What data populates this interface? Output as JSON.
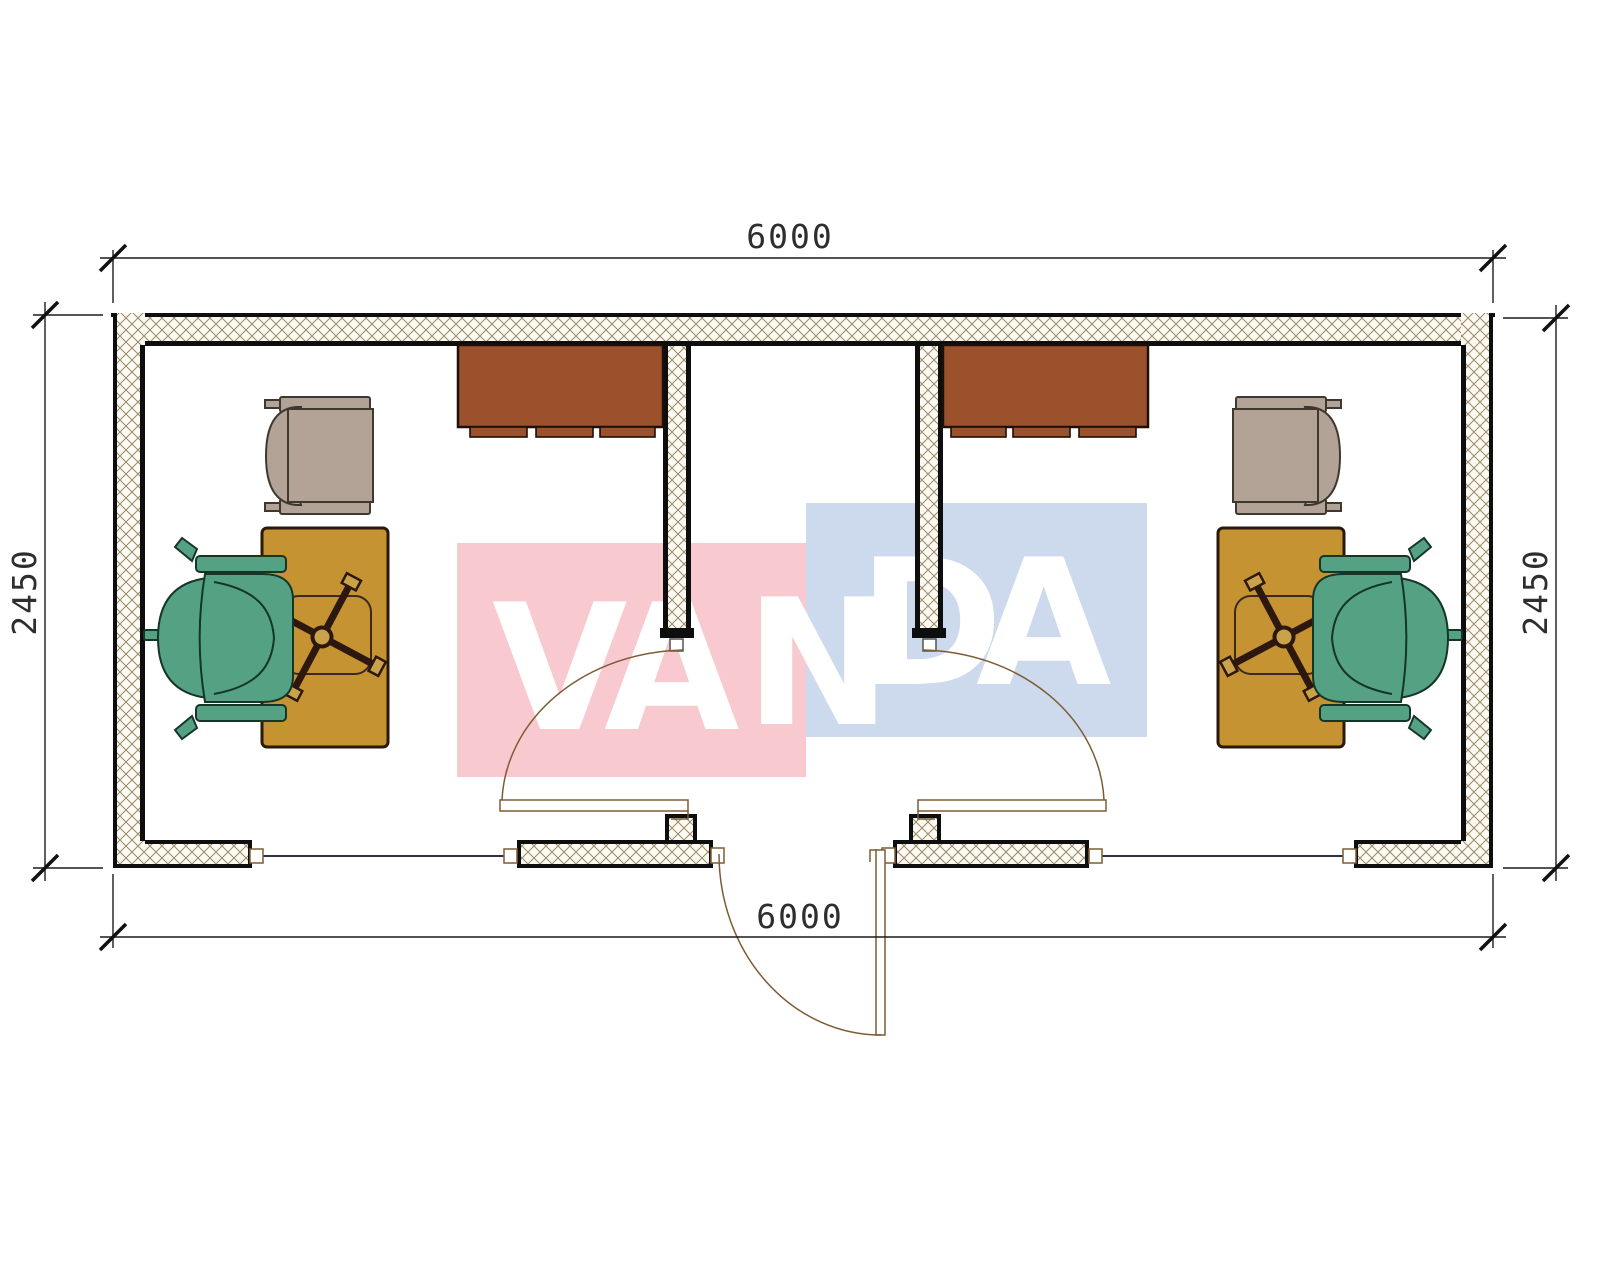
{
  "drawing": {
    "dimensions": {
      "top": "6000",
      "bottom": "6000",
      "left": "2450",
      "right": "2450"
    },
    "watermark": {
      "letters": [
        "V",
        "A",
        "N",
        "D",
        "A"
      ],
      "pink": "#f8c9cf",
      "blue": "#cdd9ec",
      "text_color": "#ffffff"
    },
    "colors": {
      "wall_hatch_line": "#998a66",
      "wall_fill": "#fdfaf3",
      "outline": "#0e0e0e",
      "cabinet": "#9b512c",
      "desk": "#c69333",
      "star_base": "#2d1810",
      "star_feet": "#c9a24a",
      "armchair": "#b2a396",
      "office_chair": "#55a183",
      "door": "#7d5c33",
      "window": "#30304e",
      "dimension": "#2e2e2e"
    }
  }
}
